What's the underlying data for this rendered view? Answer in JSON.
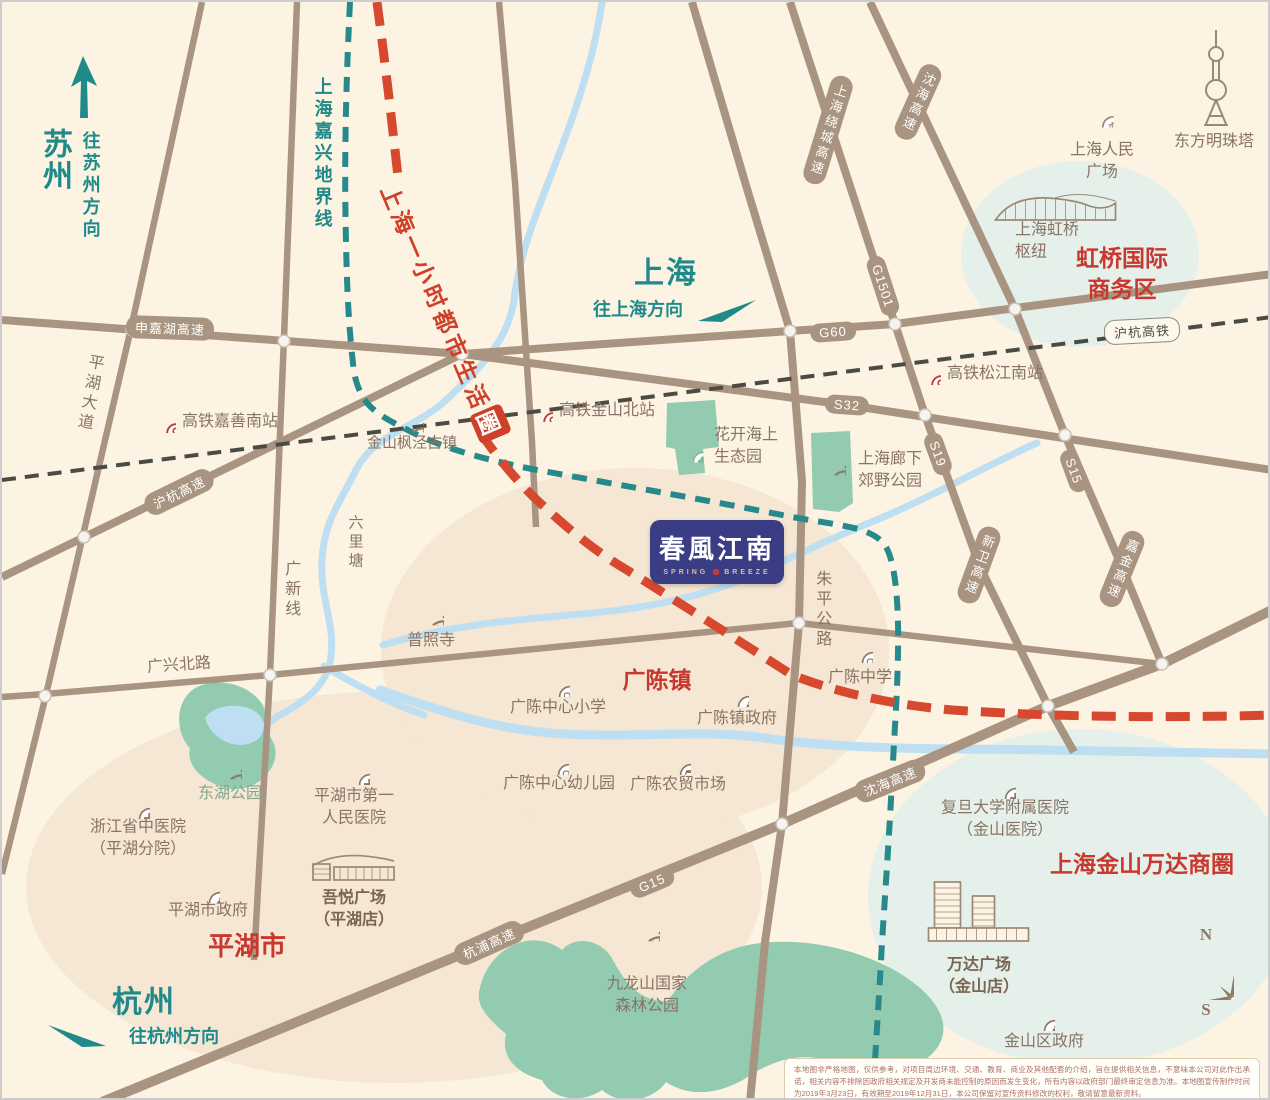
{
  "logo": {
    "cn": "春風江南",
    "en_left": "SPRING",
    "en_right": "BREEZE"
  },
  "directions": {
    "suzhou": {
      "city": "苏州",
      "note": "往苏州方向"
    },
    "shanghai": {
      "city": "上海",
      "note": "往上海方向"
    },
    "hangzhou": {
      "city": "杭州",
      "note": "往杭州方向"
    }
  },
  "lines": {
    "boundary": "上海嘉兴地界线",
    "life_circle_text": "上海一小时都市生活",
    "life_circle_last": "圈",
    "rail_hz": "沪杭高铁"
  },
  "roads": {
    "shenjiahu": "申嘉湖高速",
    "s32": "S32",
    "huhang": "沪杭高速",
    "g60": "G60",
    "g1501": "G1501",
    "raocheng": "上海绕城高速",
    "s19": "S19",
    "xinwei": "新卫高速",
    "shenhai_n": "沈海高速",
    "s15": "S15",
    "jiajin": "嘉金高速",
    "shenhai_s": "沈海高速",
    "g15": "G15",
    "hangpu": "杭浦高速",
    "pinghu_ave": "平湖大道",
    "guangxin": "广新线",
    "zhuping": "朱平公路",
    "guangxing": "广兴北路",
    "liulitang": "六里塘"
  },
  "stations": {
    "jiashan_south": "高铁嘉善南站",
    "jinshan_north": "高铁金山北站",
    "songjiang_south": "高铁松江南站"
  },
  "zones": {
    "hongqiao_line1": "虹桥国际",
    "hongqiao_line2": "商务区",
    "wanda": "上海金山万达商圈",
    "guangchen": "广陈镇",
    "pinghu": "平湖市"
  },
  "pois": {
    "people_square": {
      "line1": "上海人民",
      "line2": "广场"
    },
    "pearl_tower": {
      "line1": "东方明珠塔"
    },
    "hongqiao_hub": {
      "line1": "上海虹桥",
      "line2": "枢纽"
    },
    "fengjing": {
      "line1": "金山枫泾古镇"
    },
    "flower_sea": {
      "line1": "花开海上",
      "line2": "生态园"
    },
    "langxia": {
      "line1": "上海廊下",
      "line2": "郊野公园"
    },
    "puzhao": {
      "line1": "普照寺"
    },
    "gc_primary": {
      "line1": "广陈中心小学"
    },
    "gc_gov": {
      "line1": "广陈镇政府"
    },
    "gc_middle": {
      "line1": "广陈中学"
    },
    "gc_kinder": {
      "line1": "广陈中心幼儿园"
    },
    "gc_market": {
      "line1": "广陈农贸市场"
    },
    "donghu": {
      "line1": "东湖公园"
    },
    "zj_hospital": {
      "line1": "浙江省中医院",
      "line2": "（平湖分院）"
    },
    "ph_hospital": {
      "line1": "平湖市第一",
      "line2": "人民医院"
    },
    "ph_gov": {
      "line1": "平湖市政府"
    },
    "wuyue": {
      "line1": "吾悦广场",
      "line2": "（平湖店）"
    },
    "jiulongshan": {
      "line1": "九龙山国家",
      "line2": "森林公园"
    },
    "fudan_hospital": {
      "line1": "复旦大学附属医院",
      "line2": "（金山医院）"
    },
    "wanda_plaza": {
      "line1": "万达广场",
      "line2": "（金山店）"
    },
    "jinshan_gov": {
      "line1": "金山区政府"
    }
  },
  "compass": {
    "n": "N",
    "s": "S"
  },
  "disclaimer": "本地图非严格地图，仅供参考，对项目周边环境、交通、教育、商业及其他配套的介绍，旨在提供相关信息，不意味本公司对此作出承诺，相关内容不排除因政府相关规定及开发商未能控制的原因而发生变化，所有内容以政府部门最终审定信息为准。本地图宣传制作时间为2019年3月23日，有效期至2019年12月31日，本公司保留对宣传资料修改的权利，敬请留意最新资料。"
}
